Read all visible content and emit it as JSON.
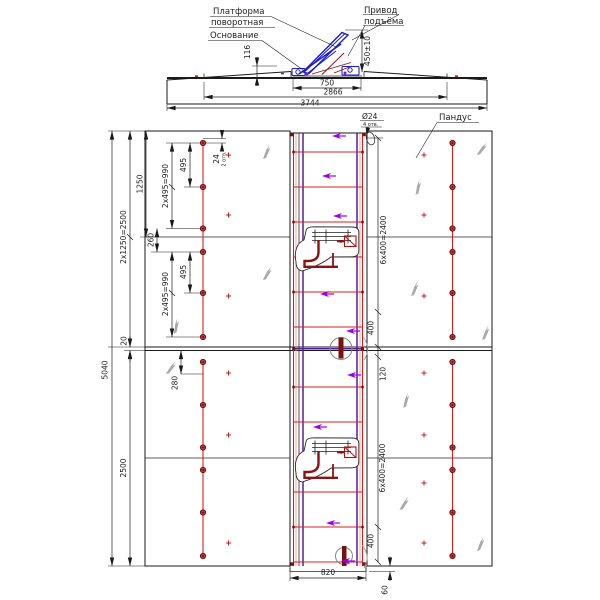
{
  "side": {
    "label_platform_1": "Платформа",
    "label_platform_2": "поворотная",
    "label_base": "Основание",
    "label_drive_1": "Привод",
    "label_drive_2": "подъёма",
    "dim_116": "116",
    "dim_450": "450±10",
    "dim_750": "750",
    "dim_2866": "2866",
    "dim_3744": "3744"
  },
  "plan": {
    "dim_5040": "5040",
    "dim_upper_half": "2x1250=2500",
    "dim_1250": "1250",
    "dim_20": "20",
    "dim_2500": "2500",
    "dim_280": "280",
    "dim_990_top": "2x495=990",
    "dim_495_top": "495",
    "dim_260": "260",
    "dim_990_mid": "2x495=990",
    "dim_495_mid": "495",
    "dim_24": "24",
    "dim_24_note": "2 отв.",
    "dim_2400_top": "6x400=2400",
    "dim_400_top": "400",
    "dim_120": "120",
    "dim_2400_bot": "6x400=2400",
    "dim_400_bot": "400",
    "dim_820": "820",
    "dim_60": "60",
    "callout_d24": "Ø24",
    "callout_d24_note": "4 отв.",
    "label_ramp": "Пандус"
  },
  "colors": {
    "outline": "#1a1a1a",
    "red": "#d42020",
    "dark_red": "#7a1010",
    "purple": "#5a1c9e",
    "violet": "#9b00e8",
    "blue": "#1f1fc8",
    "gray_leaf": "#9a9a9a"
  }
}
